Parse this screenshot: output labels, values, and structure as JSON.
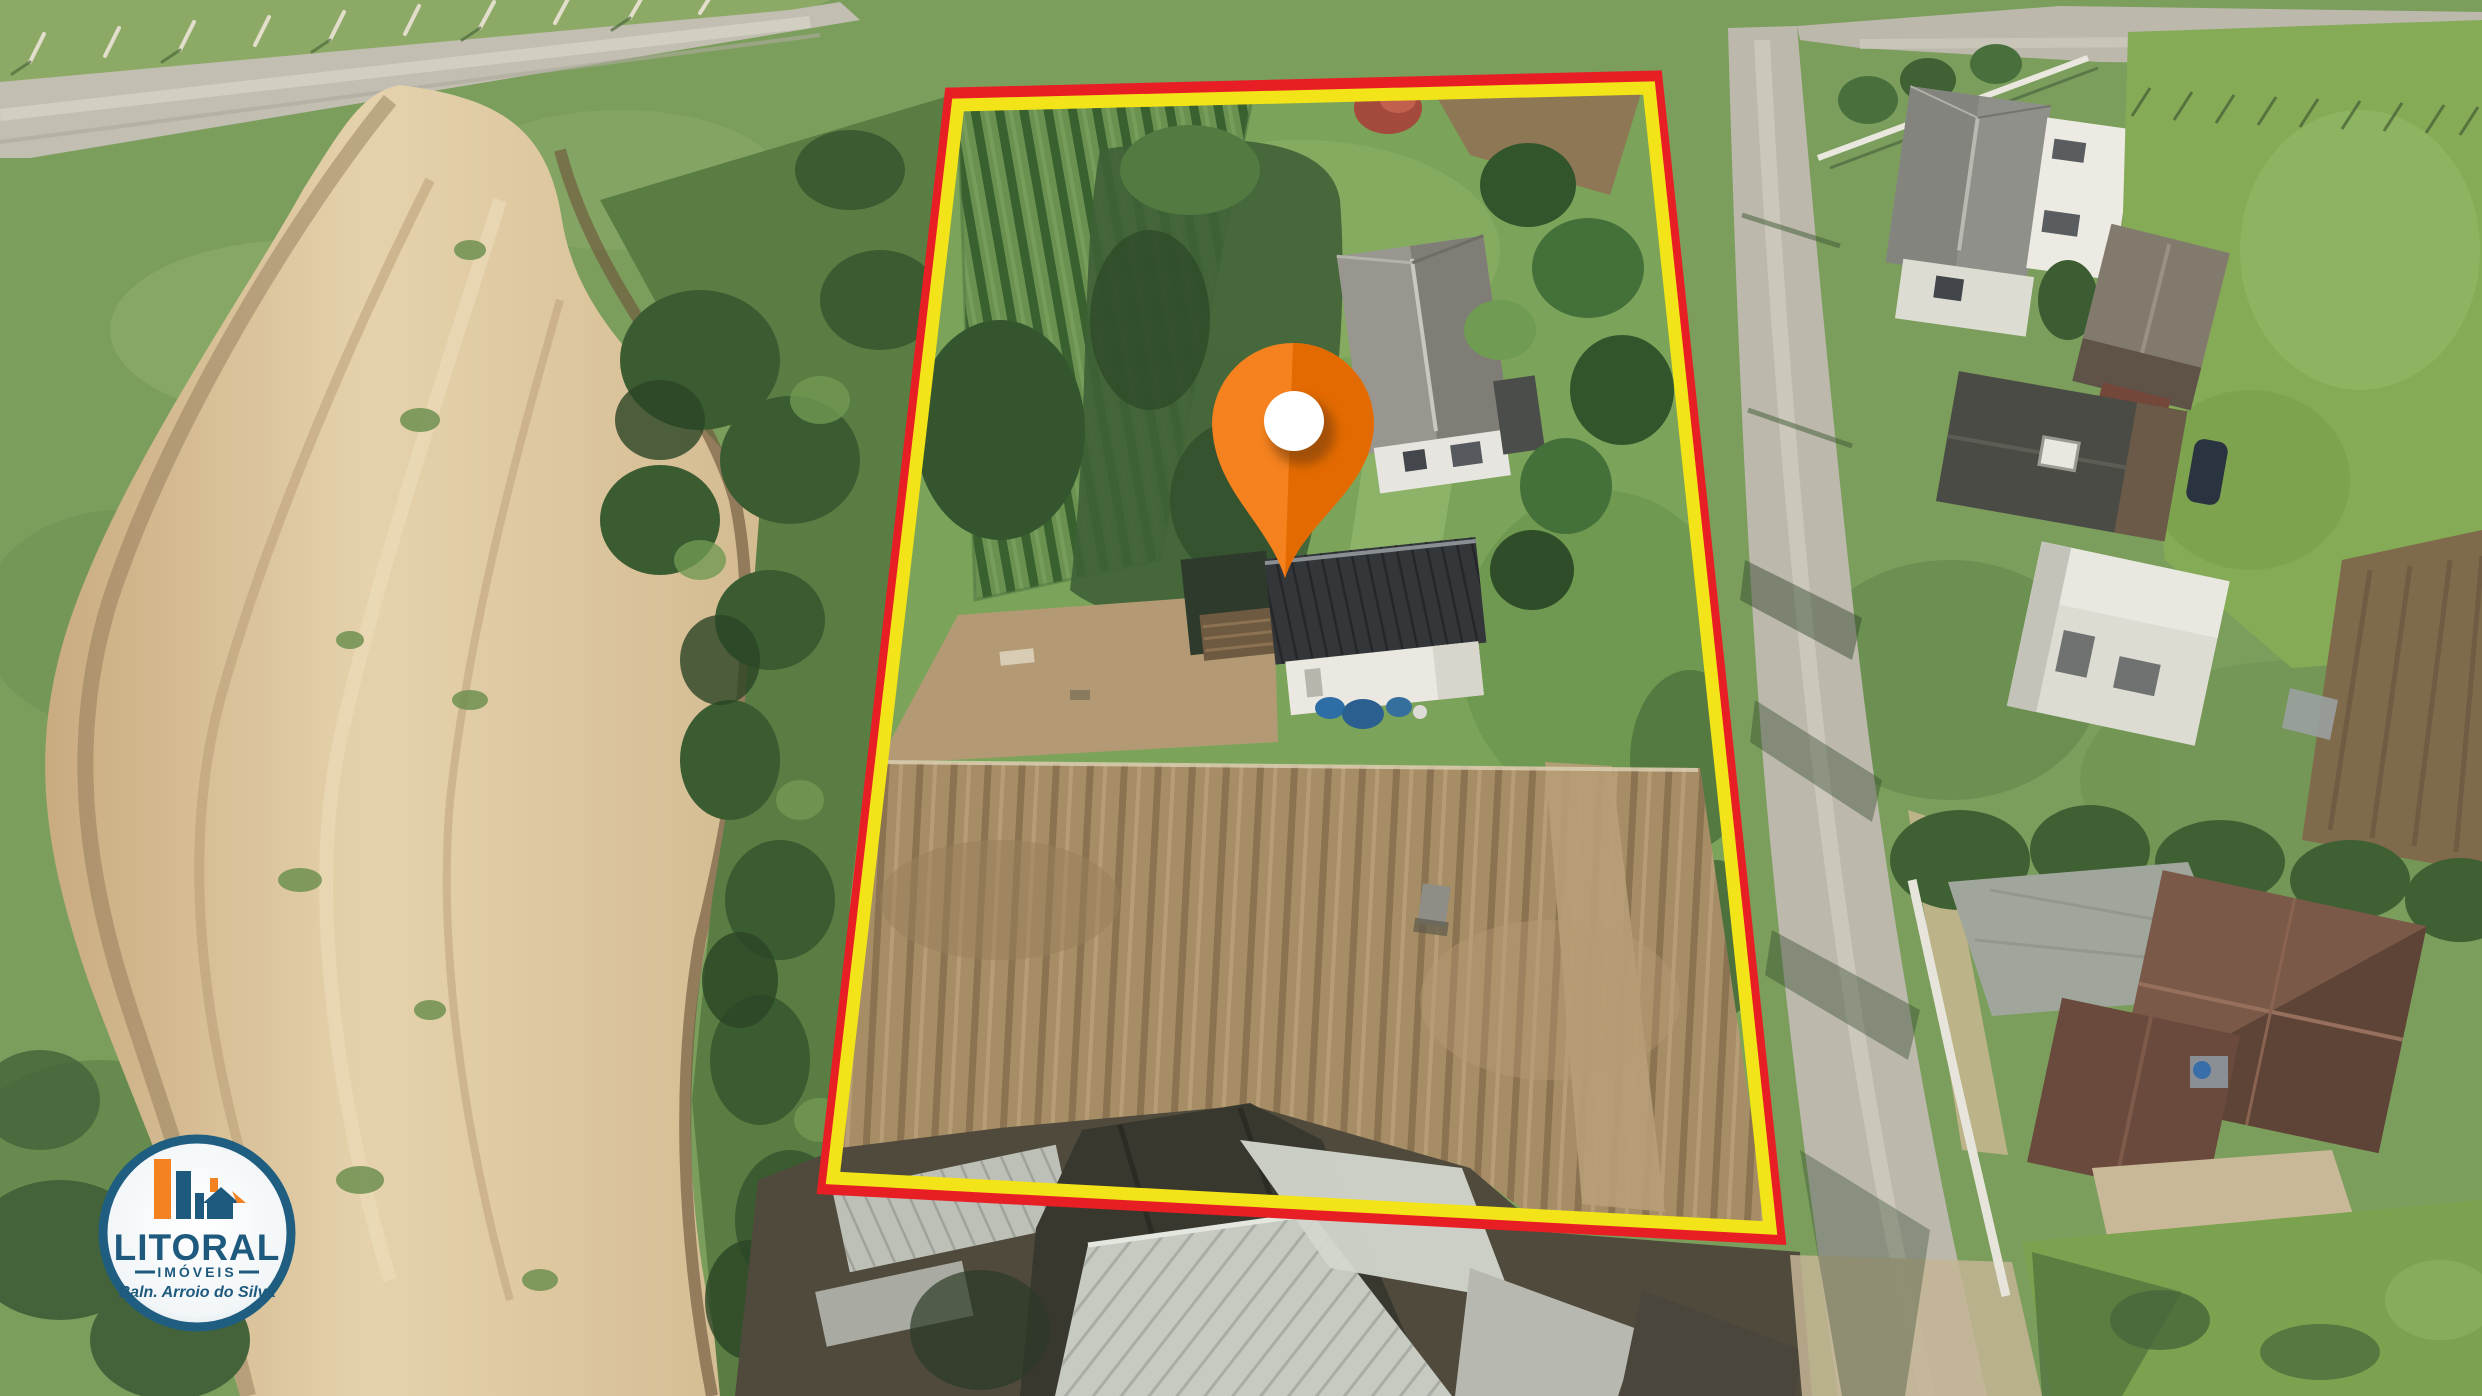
{
  "boundary": {
    "outer_color": "#e81e25",
    "inner_color": "#f2e418"
  },
  "marker": {
    "body_color": "#f5821f",
    "shade_color": "#e26a00",
    "dot_color": "#ffffff",
    "shadow_color": "#6e3a10"
  },
  "logo": {
    "name": "LITORAL",
    "category": "IMÓVEIS",
    "location": "Baln. Arroio do Silva",
    "ring_color": "#1f5e80",
    "text_color": "#1e5a7d",
    "accent_color": "#f58220",
    "badge_bg": "#ffffff"
  }
}
